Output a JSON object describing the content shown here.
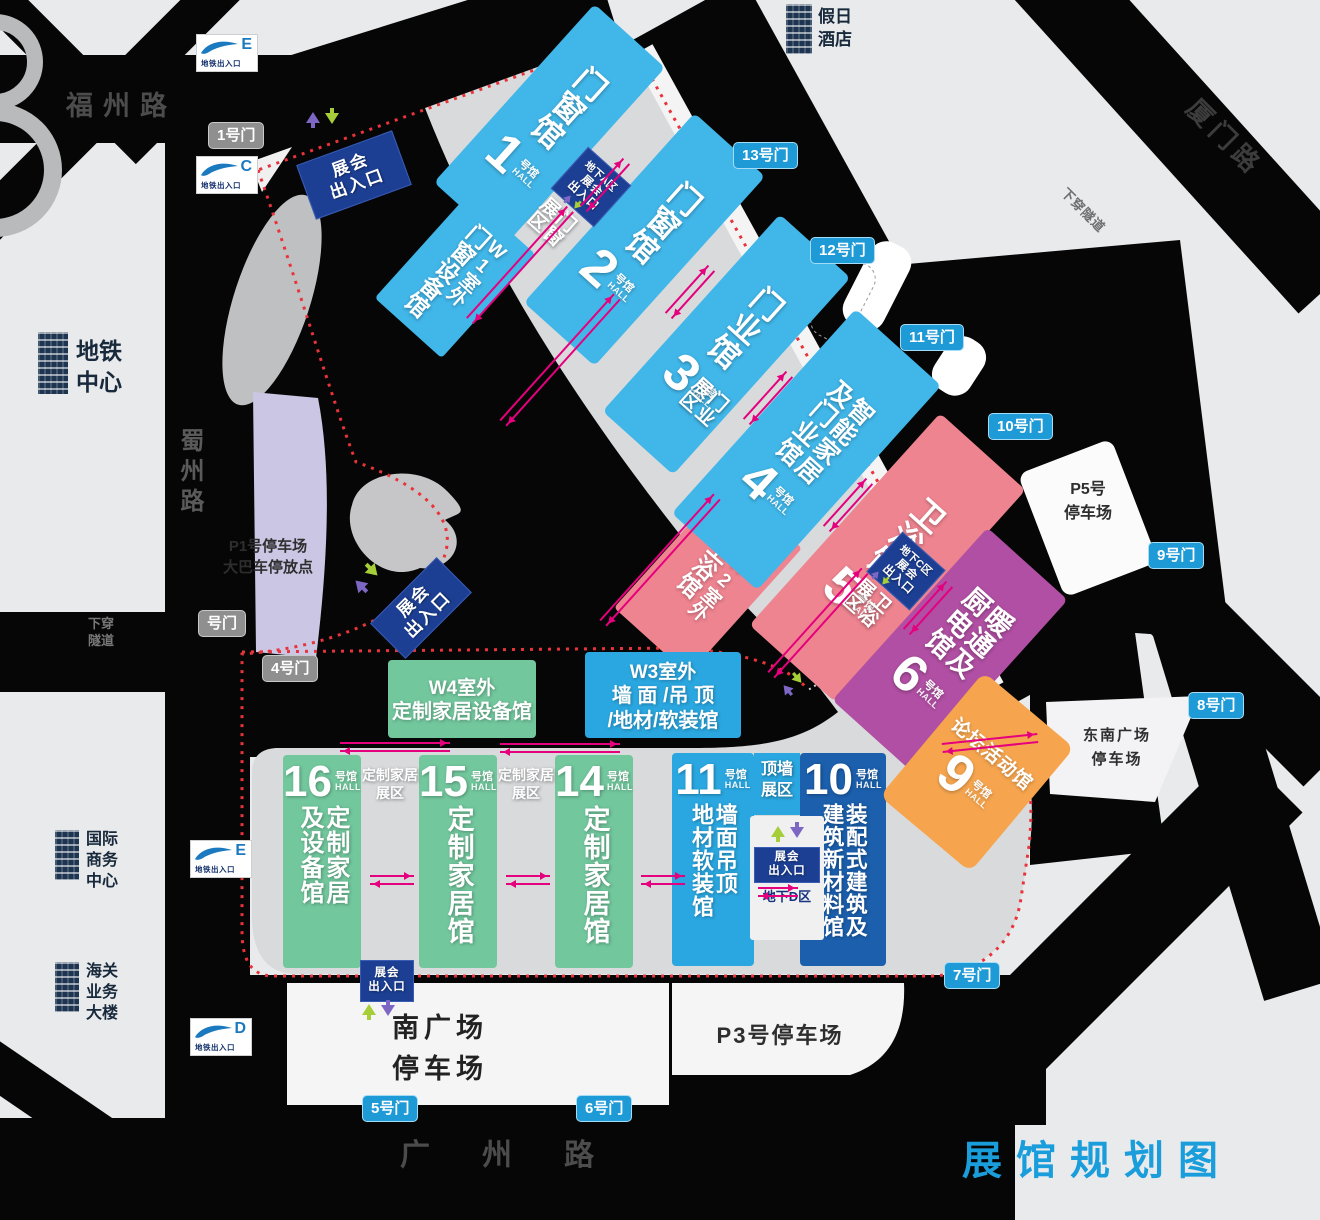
{
  "title": "展馆规划图",
  "colors": {
    "hall_blue": "#41b6e8",
    "hall_pink": "#ee8490",
    "hall_purple": "#b04fa3",
    "hall_green": "#72c79d",
    "hall_lightblue": "#2aa7e0",
    "hall_navy": "#1b5fad",
    "hall_orange": "#f6a54e",
    "entrance_navy": "#1c3f94",
    "gate_blue": "#1e9ad6",
    "gate_gray": "#8f8f8f",
    "arrow_magenta": "#e5007d",
    "boundary_red": "#e8333a",
    "title_blue": "#1a9ddb"
  },
  "roads": {
    "north": "福州路",
    "west": "蜀州路",
    "northeast": "厦门路",
    "south": "广州路",
    "tunnel_ne": "下穿隧道",
    "tunnel_west": "下穿隧道"
  },
  "buildings": {
    "hotel": "假日酒店",
    "metro_center": "地铁中心",
    "intl_business": "国际商务中心",
    "customs": "海关业务大楼"
  },
  "metro_exits": [
    {
      "letter": "E",
      "label": "地铁出入口"
    },
    {
      "letter": "C",
      "label": "地铁出入口"
    },
    {
      "letter": "E",
      "label": "地铁出入口"
    },
    {
      "letter": "D",
      "label": "地铁出入口"
    }
  ],
  "gates": [
    {
      "label": "1号门"
    },
    {
      "label": "号门"
    },
    {
      "label": "4号门"
    },
    {
      "label": "13号门"
    },
    {
      "label": "12号门"
    },
    {
      "label": "11号门"
    },
    {
      "label": "10号门"
    },
    {
      "label": "9号门"
    },
    {
      "label": "8号门"
    },
    {
      "label": "7号门"
    },
    {
      "label": "6号门"
    },
    {
      "label": "5号门"
    }
  ],
  "parking": {
    "p1_line1": "P1号停车场",
    "p1_line2": "大巴车停放点",
    "p5_line1": "P5号",
    "p5_line2": "停车场",
    "se_line1": "东南广场",
    "se_line2": "停车场",
    "south_line1": "南广场",
    "south_line2": "停车场",
    "p3": "P3号停车场"
  },
  "halls": [
    {
      "num": "1",
      "suffix": "号馆",
      "hall": "HALL",
      "cols": [
        "门窗馆"
      ]
    },
    {
      "num": "2",
      "suffix": "号馆",
      "hall": "HALL",
      "cols": [
        "门窗馆"
      ]
    },
    {
      "num": "3",
      "suffix": "号馆",
      "hall": "HALL",
      "cols": [
        "门业馆"
      ]
    },
    {
      "num": "4",
      "suffix": "号馆",
      "hall": "HALL",
      "cols": [
        "智能家居",
        "及门业馆"
      ]
    },
    {
      "num": "5",
      "suffix": "号馆",
      "hall": "HALL",
      "cols": [
        "卫浴馆"
      ]
    },
    {
      "num": "6",
      "suffix": "号馆",
      "hall": "HALL",
      "cols": [
        "暖通及",
        "厨电馆"
      ]
    },
    {
      "num": "16",
      "suffix": "号馆",
      "hall": "HALL",
      "cols": [
        "定制家居",
        "及设备馆"
      ]
    },
    {
      "num": "15",
      "suffix": "号馆",
      "hall": "HALL",
      "cols": [
        "定制家居馆"
      ]
    },
    {
      "num": "14",
      "suffix": "号馆",
      "hall": "HALL",
      "cols": [
        "定制家居馆"
      ]
    },
    {
      "num": "11",
      "suffix": "号馆",
      "hall": "HALL",
      "cols": [
        "墙面吊顶",
        "地材软装馆"
      ]
    },
    {
      "num": "10",
      "suffix": "号馆",
      "hall": "HALL",
      "cols": [
        "装配式建筑及",
        "建筑新材料馆"
      ]
    },
    {
      "num": "9",
      "suffix": "号馆",
      "hall": "HALL",
      "name": "论坛活动馆"
    }
  ],
  "outdoor_halls": [
    {
      "tag": "W1室外",
      "name": "门窗设备馆"
    },
    {
      "tag": "W2室外",
      "name": "卫浴馆"
    },
    {
      "tag": "W3室外",
      "line1": "墙 面 /吊 顶",
      "line2": "/地材/软装馆"
    },
    {
      "tag": "W4室外",
      "name": "定制家居设备馆"
    }
  ],
  "zones": [
    "门窗展区",
    "门业展区",
    "卫浴展区",
    "定制家居展区",
    "定制家居展区",
    "顶墙展区"
  ],
  "entrances": [
    {
      "line1": "展会",
      "line2": "出入口"
    },
    {
      "zone": "地下A区",
      "line1": "展会",
      "line2": "出入口"
    },
    {
      "line1": "展会",
      "line2": "出入口"
    },
    {
      "zone": "地下C区",
      "line1": "展会",
      "line2": "出入口"
    },
    {
      "zone": "地下D区",
      "line1": "展会",
      "line2": "出入口"
    },
    {
      "line1": "展会",
      "line2": "出入口"
    }
  ]
}
